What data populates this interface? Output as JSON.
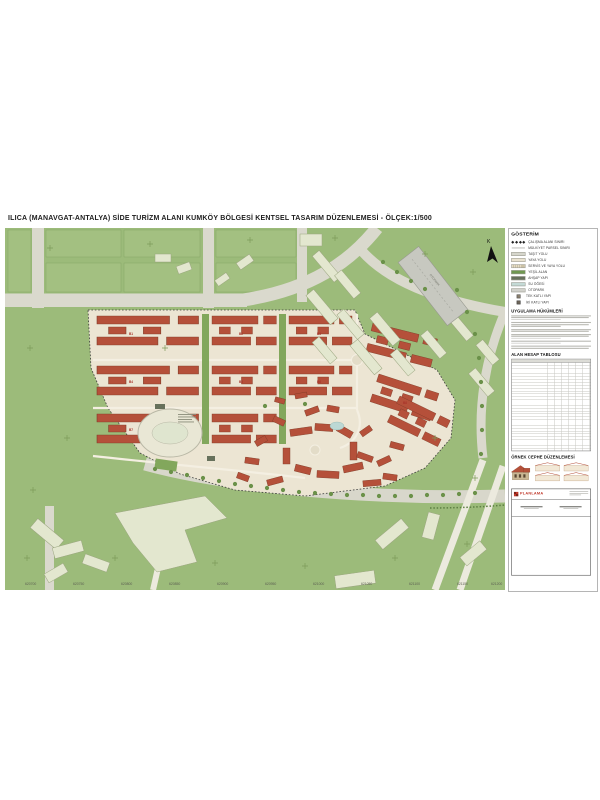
{
  "title": "ILICA (MANAVGAT-ANTALYA) SİDE TURİZM ALANI KUMKÖY BÖLGESİ KENTSEL TASARIM DÜZENLEMESİ - ÖLÇEK:1/500",
  "map": {
    "north_label": "K",
    "parking_label": "OTOPARK",
    "coords": [
      "620700",
      "620750",
      "620800",
      "620850",
      "620900",
      "620950",
      "621000",
      "621050",
      "621100",
      "621150",
      "621200"
    ],
    "block_labels": [
      "B1",
      "B2",
      "B3",
      "B4",
      "B5",
      "B6",
      "B7",
      "B8"
    ]
  },
  "legend": {
    "heading": "GÖSTERİM",
    "items": [
      {
        "label": "ÇALIŞMA ALANI SINIRI",
        "type": "boundary"
      },
      {
        "label": "MÜLKİYET PARSEL SINIRI",
        "type": "parcel-line"
      },
      {
        "label": "TAŞIT YOLU",
        "type": "road",
        "color": "#d6d6cc"
      },
      {
        "label": "YAYA YOLU",
        "type": "path",
        "color": "#eae3d0"
      },
      {
        "label": "SERVİS VE YAYA YOLU",
        "type": "service",
        "color": "#e4dcc6"
      },
      {
        "label": "YEŞİL ALAN",
        "type": "green",
        "color": "#6f9850"
      },
      {
        "label": "AHŞAP YAPI",
        "type": "wood",
        "color": "#67715c"
      },
      {
        "label": "SU ÖĞESİ",
        "type": "water",
        "color": "#c4dad6"
      },
      {
        "label": "OTOPARK",
        "type": "parking",
        "color": "#d2d2cc"
      },
      {
        "label": "TEK KATLI YAPI",
        "type": "one-story-marker"
      },
      {
        "label": "İKİ KATLI YAPI",
        "type": "two-story-marker"
      }
    ],
    "sections": {
      "provisions_heading": "UYGULAMA HÜKÜMLERİ",
      "area_table_heading": "ALAN HESAP TABLOSU",
      "facade_heading": "ÖRNEK CEPHE DÜZENLEMESİ"
    },
    "titleblock": {
      "firm": "PLANLAMA"
    }
  },
  "colors": {
    "map_green": "#9cbb7a",
    "development_ground": "#ece5d3",
    "roof_red": "#b5503a",
    "road_gray": "#dad9cd",
    "existing_building": "#e3e7cf",
    "water": "#bcd8d4"
  }
}
